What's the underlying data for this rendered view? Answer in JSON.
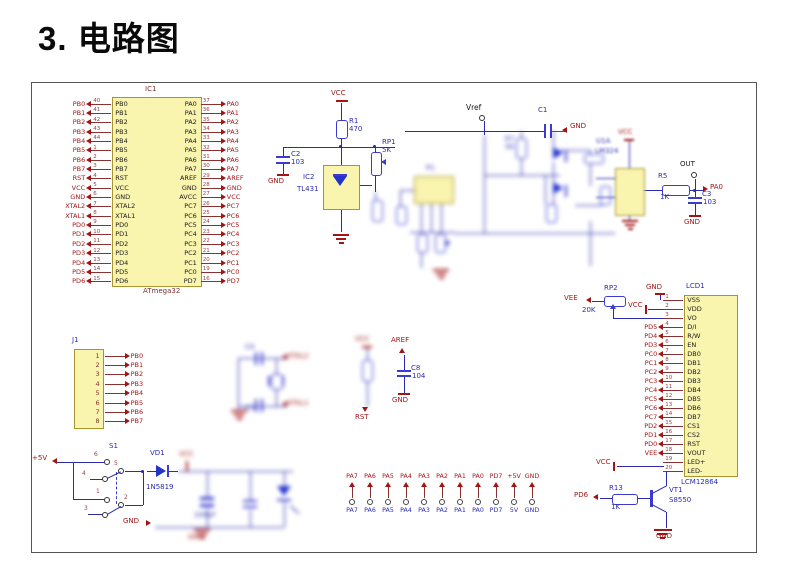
{
  "title": "3. 电路图",
  "colors": {
    "wire": "#2b2bb0",
    "net_label": "#a31515",
    "component": "#3b3bd0",
    "box_fill": "#f9f4ae"
  },
  "ic1": {
    "designator": "IC1",
    "part": "ATmega32",
    "rows": [
      {
        "lnet": "PB0",
        "lnum": "40",
        "lname": "PB0",
        "rname": "PA0",
        "rnum": "37",
        "rnet": "PA0"
      },
      {
        "lnet": "PB1",
        "lnum": "41",
        "lname": "PB1",
        "rname": "PA1",
        "rnum": "36",
        "rnet": "PA1"
      },
      {
        "lnet": "PB2",
        "lnum": "42",
        "lname": "PB2",
        "rname": "PA2",
        "rnum": "35",
        "rnet": "PA2"
      },
      {
        "lnet": "PB3",
        "lnum": "43",
        "lname": "PB3",
        "rname": "PA3",
        "rnum": "34",
        "rnet": "PA3"
      },
      {
        "lnet": "PB4",
        "lnum": "44",
        "lname": "PB4",
        "rname": "PA4",
        "rnum": "33",
        "rnet": "PA4"
      },
      {
        "lnet": "PB5",
        "lnum": "1",
        "lname": "PB5",
        "rname": "PA5",
        "rnum": "32",
        "rnet": "PA5"
      },
      {
        "lnet": "PB6",
        "lnum": "2",
        "lname": "PB6",
        "rname": "PA6",
        "rnum": "31",
        "rnet": "PA6"
      },
      {
        "lnet": "PB7",
        "lnum": "3",
        "lname": "PB7",
        "rname": "PA7",
        "rnum": "30",
        "rnet": "PA7"
      },
      {
        "lnet": "RST",
        "lnum": "4",
        "lname": "RST",
        "rname": "AREF",
        "rnum": "29",
        "rnet": "AREF"
      },
      {
        "lnet": "VCC",
        "lnum": "5",
        "lname": "VCC",
        "rname": "GND",
        "rnum": "28",
        "rnet": "GND"
      },
      {
        "lnet": "GND",
        "lnum": "6",
        "lname": "GND",
        "rname": "AVCC",
        "rnum": "27",
        "rnet": "VCC"
      },
      {
        "lnet": "XTAL2",
        "lnum": "7",
        "lname": "XTAL2",
        "rname": "PC7",
        "rnum": "26",
        "rnet": "PC7"
      },
      {
        "lnet": "XTAL1",
        "lnum": "8",
        "lname": "XTAL1",
        "rname": "PC6",
        "rnum": "25",
        "rnet": "PC6"
      },
      {
        "lnet": "PD0",
        "lnum": "9",
        "lname": "PD0",
        "rname": "PC5",
        "rnum": "24",
        "rnet": "PC5"
      },
      {
        "lnet": "PD1",
        "lnum": "10",
        "lname": "PD1",
        "rname": "PC4",
        "rnum": "23",
        "rnet": "PC4"
      },
      {
        "lnet": "PD2",
        "lnum": "11",
        "lname": "PD2",
        "rname": "PC3",
        "rnum": "22",
        "rnet": "PC3"
      },
      {
        "lnet": "PD3",
        "lnum": "12",
        "lname": "PD3",
        "rname": "PC2",
        "rnum": "21",
        "rnet": "PC2"
      },
      {
        "lnet": "PD4",
        "lnum": "13",
        "lname": "PD4",
        "rname": "PC1",
        "rnum": "20",
        "rnet": "PC1"
      },
      {
        "lnet": "PD5",
        "lnum": "14",
        "lname": "PD5",
        "rname": "PC0",
        "rnum": "19",
        "rnet": "PC0"
      },
      {
        "lnet": "PD6",
        "lnum": "15",
        "lname": "PD6",
        "rname": "PD7",
        "rnum": "16",
        "rnet": "PD7"
      }
    ]
  },
  "j1": {
    "designator": "J1",
    "rows": [
      {
        "num": "1",
        "net": "PB0"
      },
      {
        "num": "2",
        "net": "PB1"
      },
      {
        "num": "3",
        "net": "PB2"
      },
      {
        "num": "4",
        "net": "PB3"
      },
      {
        "num": "5",
        "net": "PB4"
      },
      {
        "num": "6",
        "net": "PB5"
      },
      {
        "num": "7",
        "net": "PB6"
      },
      {
        "num": "8",
        "net": "PB7"
      }
    ]
  },
  "lcd": {
    "designator": "LCD1",
    "part": "LCM12864",
    "gnd": "GND",
    "vcc_vdd": "VCC",
    "vcc_led": "VCC",
    "rp2": "RP2",
    "rp2_val": "20K",
    "vee": "VEE",
    "rows": [
      {
        "num": "1",
        "name": "VSS",
        "net": ""
      },
      {
        "num": "2",
        "name": "VDD",
        "net": ""
      },
      {
        "num": "3",
        "name": "VO",
        "net": ""
      },
      {
        "num": "4",
        "name": "D/I",
        "net": "PD5"
      },
      {
        "num": "5",
        "name": "R/W",
        "net": "PD4"
      },
      {
        "num": "6",
        "name": "EN",
        "net": "PD3"
      },
      {
        "num": "7",
        "name": "DB0",
        "net": "PC0"
      },
      {
        "num": "8",
        "name": "DB1",
        "net": "PC1"
      },
      {
        "num": "9",
        "name": "DB2",
        "net": "PC2"
      },
      {
        "num": "10",
        "name": "DB3",
        "net": "PC3"
      },
      {
        "num": "11",
        "name": "DB4",
        "net": "PC4"
      },
      {
        "num": "12",
        "name": "DB5",
        "net": "PC5"
      },
      {
        "num": "13",
        "name": "DB6",
        "net": "PC6"
      },
      {
        "num": "14",
        "name": "DB7",
        "net": "PC7"
      },
      {
        "num": "15",
        "name": "CS1",
        "net": "PD2"
      },
      {
        "num": "16",
        "name": "CS2",
        "net": "PD1"
      },
      {
        "num": "17",
        "name": "RST",
        "net": "PD0"
      },
      {
        "num": "18",
        "name": "VOUT",
        "net": "VEE"
      },
      {
        "num": "19",
        "name": "LED+",
        "net": ""
      },
      {
        "num": "20",
        "name": "LED-",
        "net": ""
      }
    ]
  },
  "refcell": {
    "vcc": "VCC",
    "r1": "R1",
    "r1_val": "470",
    "c2": "C2",
    "c2_val": "103",
    "gnd": "GND",
    "ic2": "IC2",
    "ic2_part": "TL431",
    "rp1": "RP1",
    "rp1_val": "5K"
  },
  "mid": {
    "vref": "Vref",
    "c1": "C1",
    "gnd": "GND",
    "p1": "P1",
    "r7": "R7",
    "r7_val": "5K"
  },
  "opamp": {
    "designator": "U1A",
    "part": "LM324",
    "vcc": "VCC",
    "r5": "R5",
    "r5_val": "1K",
    "out": "OUT",
    "pa0": "PA0",
    "c3": "C3",
    "c3_val": "103",
    "gnd": "GND"
  },
  "xtal": {
    "c4": "C4",
    "c5": "C5",
    "xtal2": "XTAL2",
    "xtal1": "XTAL1"
  },
  "rst": {
    "vcc": "VCC",
    "label": "RST"
  },
  "aref": {
    "label": "AREF",
    "c8": "C8",
    "c8_val": "104",
    "gnd": "GND"
  },
  "power": {
    "plus5v": "+5V",
    "s1": "S1",
    "pin6": "6",
    "pin4": "4",
    "pin1": "1",
    "pin3": "3",
    "pin5": "5",
    "pin2": "2",
    "vd1": "VD1",
    "vd1_part": "1N5819",
    "vcc": "VCC",
    "cap_val": "100uF",
    "gnd_label": "GND",
    "gnd_sym": "GND"
  },
  "vt1": {
    "pd6": "PD6",
    "r13": "R13",
    "r13_val": "1K",
    "designator": "VT1",
    "part": "S8550",
    "gnd": "GND"
  },
  "conn": {
    "cols": [
      {
        "top": "PA7",
        "bottom": "PA7"
      },
      {
        "top": "PA6",
        "bottom": "PA6"
      },
      {
        "top": "PA5",
        "bottom": "PA5"
      },
      {
        "top": "PA4",
        "bottom": "PA4"
      },
      {
        "top": "PA3",
        "bottom": "PA3"
      },
      {
        "top": "PA2",
        "bottom": "PA2"
      },
      {
        "top": "PA1",
        "bottom": "PA1"
      },
      {
        "top": "PA0",
        "bottom": "PA0"
      },
      {
        "top": "PD7",
        "bottom": "PD7"
      },
      {
        "top": "+5V",
        "bottom": "5V"
      },
      {
        "top": "GND",
        "bottom": "GND"
      }
    ]
  }
}
